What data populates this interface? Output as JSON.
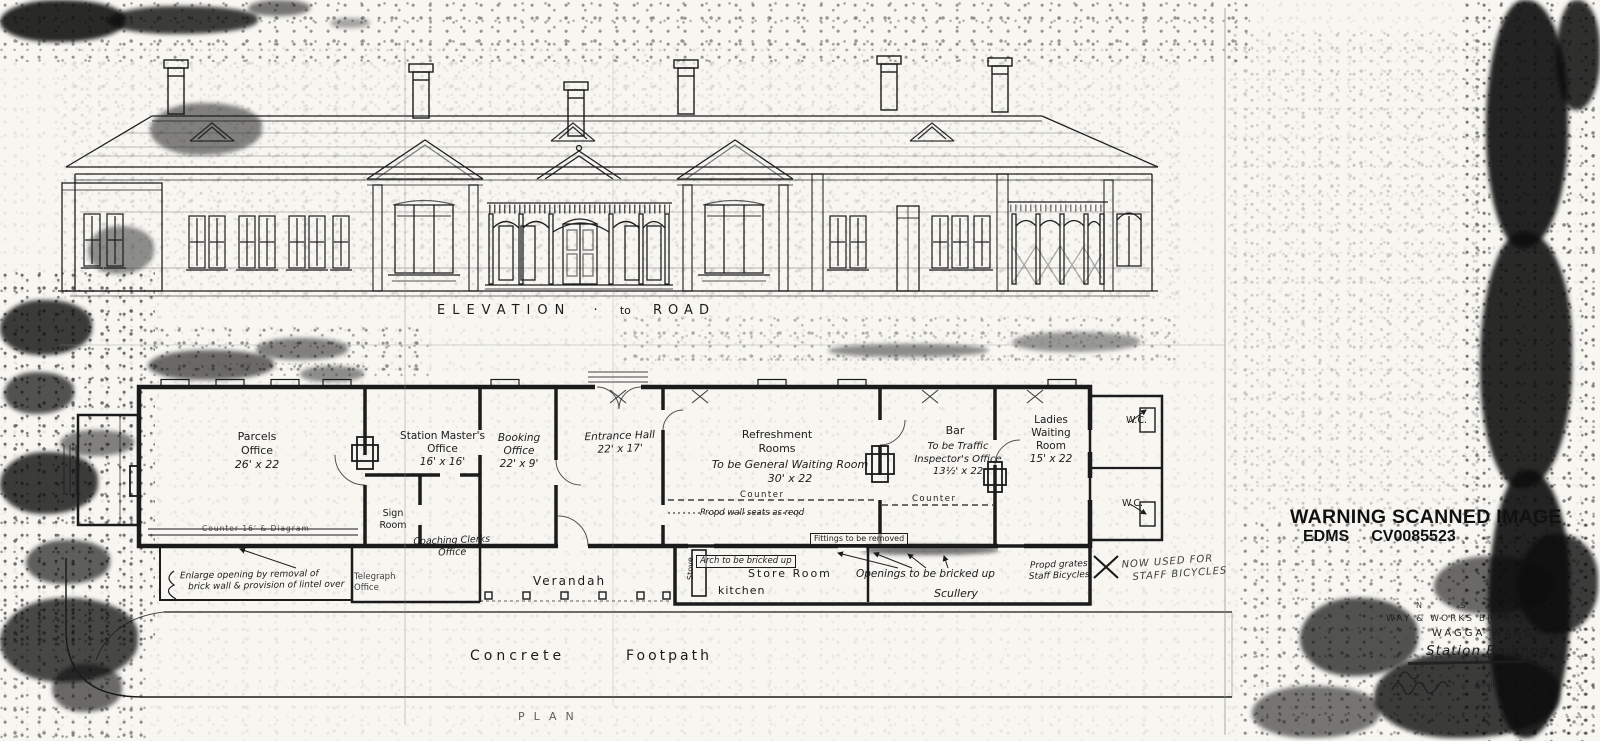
{
  "colors": {
    "ink": "#1b1b1b",
    "paper": "#f7f6f1"
  },
  "stamp": {
    "warning": "WARNING SCANNED IMAGE",
    "edms_label": "EDMS",
    "edms_number": "CV0085523"
  },
  "captions": {
    "elevation_word": "ELEVATION",
    "elevation_dot": "·",
    "elevation_to": "to",
    "elevation_road": "ROAD",
    "plan": "PLAN",
    "footpath_1": "Concrete",
    "footpath_2": "Footpath"
  },
  "rooms": {
    "parcels": [
      "Parcels",
      "Office",
      "26' x 22"
    ],
    "station_master": [
      "Station Master's",
      "Office",
      "16' x 16'"
    ],
    "booking": [
      "Booking",
      "Office",
      "22' x 9'"
    ],
    "entrance_hall": [
      "Entrance Hall",
      "22' x 17'"
    ],
    "refreshment": [
      "Refreshment",
      "Rooms"
    ],
    "refreshment_note": [
      "To be General Waiting Room",
      "30' x 22"
    ],
    "bar": "Bar",
    "bar_note": [
      "To be Traffic",
      "Inspector's Office",
      "13½' x 22"
    ],
    "ladies": [
      "Ladies",
      "Waiting",
      "Room",
      "15' x 22"
    ],
    "sign": [
      "Sign",
      "Room"
    ],
    "coaching": [
      "Coaching Clerks",
      "Office"
    ],
    "telegraph": [
      "Telegraph",
      "Office"
    ],
    "verandah": "Verandah",
    "stove": "Stove",
    "kitchen": "kitchen",
    "store": "Store Room",
    "scullery": "Scullery",
    "wc_upper": "W.C.",
    "wc_lower": "W.C."
  },
  "annotations": {
    "counter_refreshment": "Counter",
    "counter_bar": "Counter",
    "counter_parcels": "Counter 16' & Diagram",
    "wall_seats": "Propd wall seats as reqd",
    "fittings": "Fittings to be removed",
    "arch": "Arch to be bricked up",
    "openings": "Openings to be bricked up",
    "grates": [
      "Propd grates",
      "Staff Bicycles"
    ],
    "handwritten": [
      "NOW USED FOR",
      "STAFF BICYCLES"
    ],
    "enlarge": [
      "Enlarge opening by removal of",
      "brick wall & provision of lintel over"
    ]
  },
  "titleblock": {
    "lines": [
      "N  S  W",
      "WAY & WORKS BRANCH",
      "WAGGA WAGGA",
      "Station Building",
      "Scale:"
    ]
  }
}
